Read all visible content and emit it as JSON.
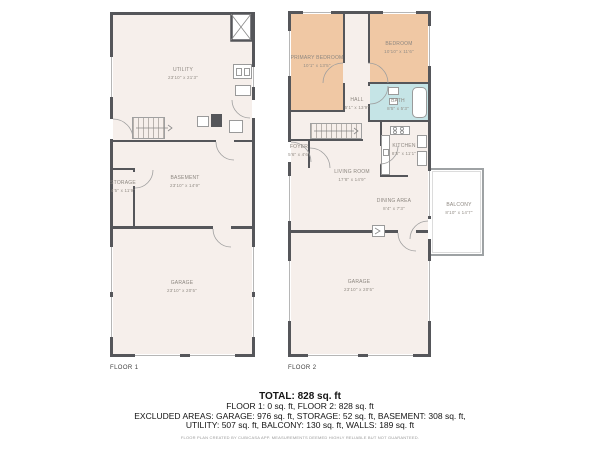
{
  "floor1": {
    "label": "FLOOR 1",
    "rooms": {
      "utility": {
        "name": "UTILITY",
        "dims": "23'10\" x 21'3\""
      },
      "storage": {
        "name": "STORAGE",
        "dims": "4'5\" x 11'9\""
      },
      "basement": {
        "name": "BASEMENT",
        "dims": "23'10\" x 14'9\""
      },
      "garage": {
        "name": "GARAGE",
        "dims": "23'10\" x 20'5\""
      }
    }
  },
  "floor2": {
    "label": "FLOOR 2",
    "rooms": {
      "primary_bedroom": {
        "name": "PRIMARY BEDROOM",
        "dims": "10'1\" x 13'5\""
      },
      "bedroom": {
        "name": "BEDROOM",
        "dims": "10'10\" x 11'6\""
      },
      "hall": {
        "name": "HALL",
        "dims": "5'1\" x 13'9\""
      },
      "bath": {
        "name": "BATH",
        "dims": "8'5\" x 5'3\""
      },
      "foyer": {
        "name": "FOYER",
        "dims": "5'6\" x 4'6\""
      },
      "kitchen": {
        "name": "KITCHEN",
        "dims": "8'5\" x 11'1\""
      },
      "living_room": {
        "name": "LIVING ROOM",
        "dims": "17'8\" x 14'9\""
      },
      "dining_area": {
        "name": "DINING AREA",
        "dims": "8'4\" x 7'3\""
      },
      "balcony": {
        "name": "BALCONY",
        "dims": "8'10\" x 14'7\""
      },
      "garage": {
        "name": "GARAGE",
        "dims": "23'10\" x 20'5\""
      }
    }
  },
  "summary": {
    "total": "TOTAL: 828 sq. ft",
    "floors": "FLOOR 1: 0 sq. ft, FLOOR 2: 828 sq. ft",
    "excluded1": "EXCLUDED AREAS: GARAGE: 976 sq. ft, STORAGE: 52 sq. ft, BASEMENT: 308 sq. ft,",
    "excluded2": "UTILITY: 507 sq. ft, BALCONY: 130 sq. ft, WALLS: 189 sq. ft",
    "disclaimer": "FLOOR PLAN CREATED BY CUBICASA APP. MEASUREMENTS DEEMED HIGHLY RELIABLE BUT NOT GUARANTEED."
  },
  "colors": {
    "wall": "#55565a",
    "floor_fill": "#f6efeb",
    "bedroom_fill": "#f0c8a4",
    "bath_fill": "#c5e4e6",
    "label_text": "#8d8780"
  }
}
